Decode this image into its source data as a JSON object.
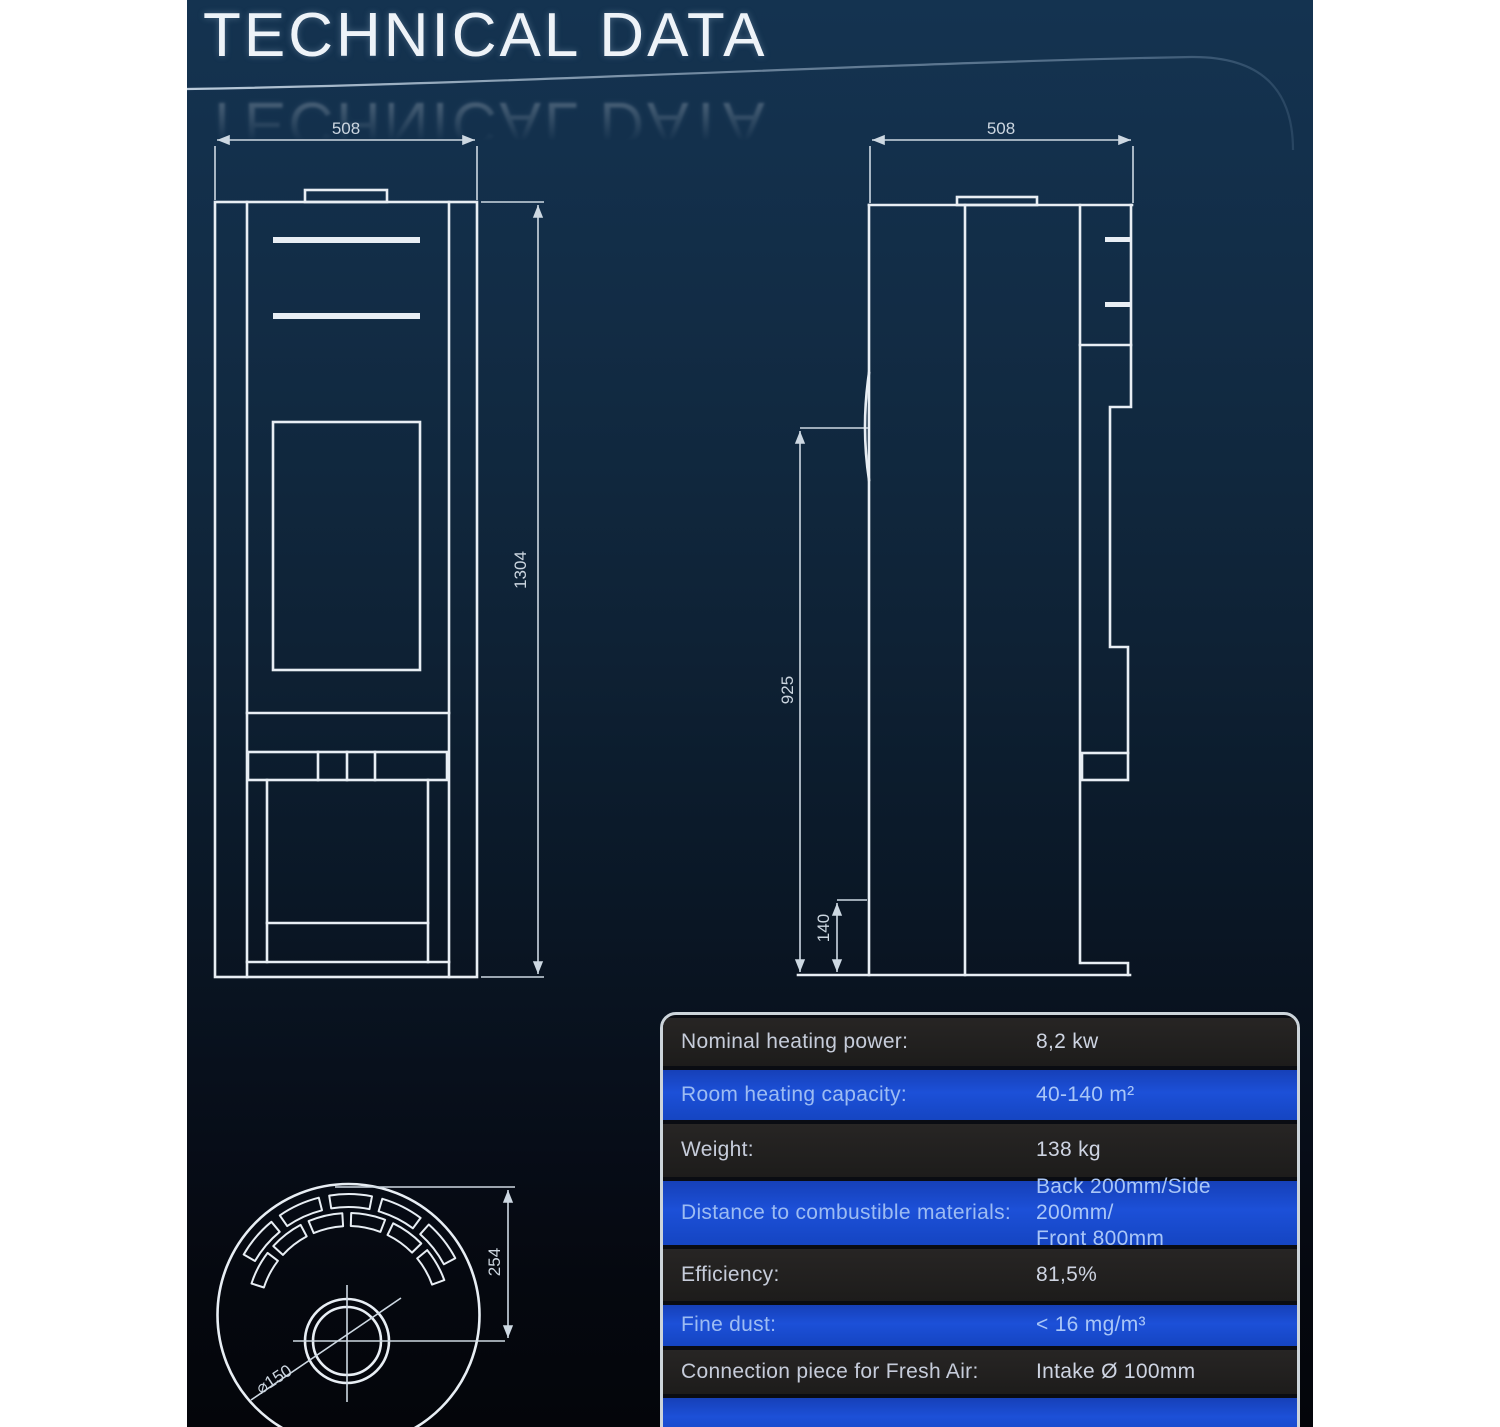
{
  "title": "TECHNICAL DATA",
  "drawings": {
    "front_view": {
      "width_label": "508",
      "height_label": "1304"
    },
    "side_view": {
      "width_label": "508",
      "upper_height_label": "925",
      "base_height_label": "140"
    },
    "top_view": {
      "depth_label": "254",
      "flue_diameter_label": "⌀150"
    }
  },
  "table": {
    "rows": [
      {
        "label": "Nominal heating power:",
        "value": "8,2 kw",
        "tone": "dark"
      },
      {
        "label": "Room heating capacity:",
        "value": "40-140 m²",
        "tone": "blue"
      },
      {
        "label": "Weight:",
        "value": "138 kg",
        "tone": "dark"
      },
      {
        "label": "Distance to combustible materials:",
        "value": "Back 200mm/Side 200mm/\nFront 800mm",
        "tone": "blue"
      },
      {
        "label": "Efficiency:",
        "value": "81,5%",
        "tone": "dark"
      },
      {
        "label": "Fine dust:",
        "value": "< 16 mg/m³",
        "tone": "blue"
      },
      {
        "label": "Connection piece for Fresh Air:",
        "value": "Intake Ø 100mm",
        "tone": "dark"
      },
      {
        "label": "",
        "value": "",
        "tone": "blue"
      }
    ]
  },
  "colors": {
    "row_blue": "#1c50d8",
    "row_dark": "#1d1c1b",
    "table_border": "#ccd4da",
    "line_color": "#e8eef4",
    "background_top": "#143350",
    "background_bottom": "#04050a"
  }
}
